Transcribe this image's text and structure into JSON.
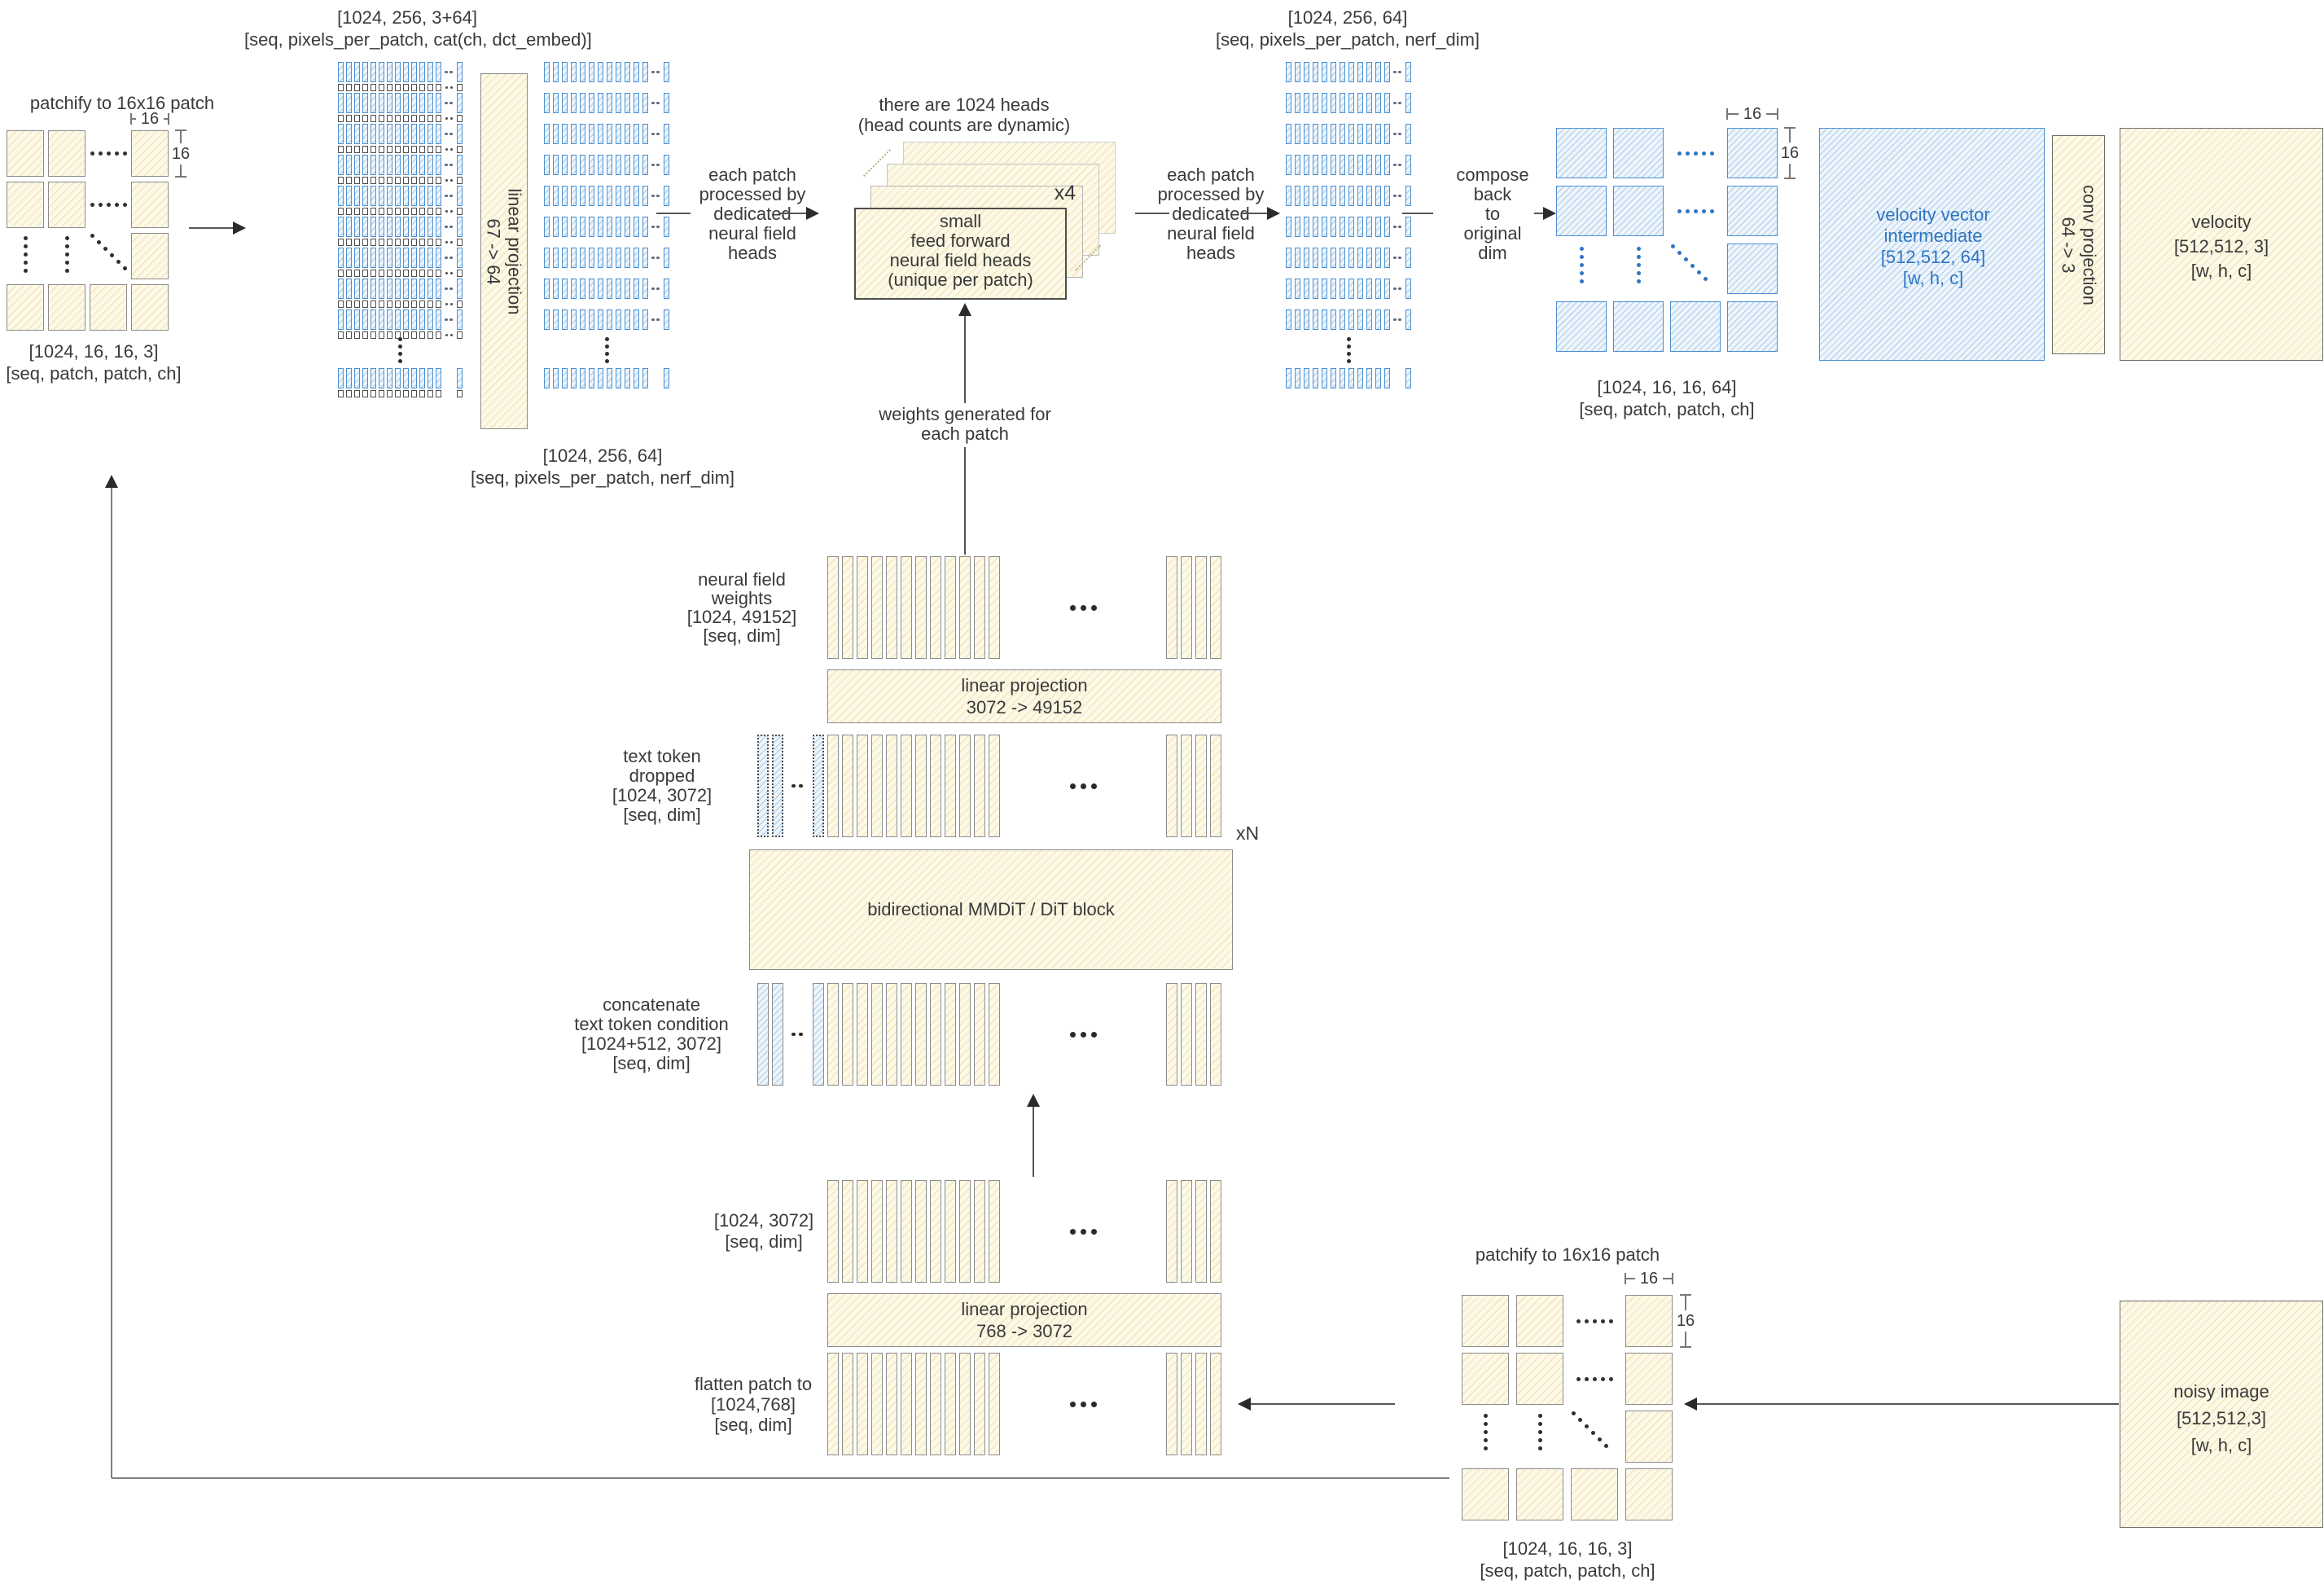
{
  "palette": {
    "cream_fill": "#fdf9e8",
    "cream_hatch": "#debE64",
    "blue_line": "#4a90d2",
    "blue_fill": "#eef5fb",
    "blue_text": "#2e75c3",
    "ink": "#3a3a3a",
    "arrow": "#2b2b2b"
  },
  "sixteen": "16",
  "top_left": {
    "title": "patchify to 16x16 patch",
    "shape": "[1024, 16, 16, 3]",
    "dims": "[seq, patch, patch, ch]"
  },
  "dct_label": {
    "shape": "[1024, 256, 3+64]",
    "dims": "[seq, pixels_per_patch, cat(ch, dct_embed)]"
  },
  "proj67": {
    "title": "linear projection",
    "map": "67 -> 64"
  },
  "nerf_label": {
    "shape": "[1024, 256, 64]",
    "dims": "[seq, pixels_per_patch, nerf_dim]"
  },
  "flow_left": [
    "each patch",
    "processed by",
    "dedicated",
    "neural field",
    "heads"
  ],
  "heads_note": [
    "there are 1024 heads",
    "(head counts are dynamic)"
  ],
  "ff_stack": {
    "lines": [
      "small",
      "feed forward",
      "neural field heads",
      "(unique per patch)"
    ],
    "multiplier": "x4"
  },
  "weights_gen": [
    "weights generated for",
    "each patch"
  ],
  "nerf_out_label": {
    "shape": "[1024, 256, 64]",
    "dims": "[seq, pixels_per_patch, nerf_dim]"
  },
  "flow_right": [
    "each patch",
    "processed by",
    "dedicated",
    "neural field",
    "heads"
  ],
  "compose": [
    "compose",
    "back",
    "to",
    "original",
    "dim"
  ],
  "patch_out": {
    "shape": "[1024, 16, 16, 64]",
    "dims": "[seq, patch, patch, ch]"
  },
  "velocity_intermediate": [
    "velocity vector",
    "intermediate",
    "[512,512, 64]",
    "[w, h, c]"
  ],
  "conv_proj": {
    "title": "conv projection",
    "map": "64 -> 3"
  },
  "velocity": [
    "velocity",
    "[512,512, 3]",
    "[w, h, c]"
  ],
  "nf_weights": [
    "neural field",
    "weights",
    "[1024, 49152]",
    "[seq, dim]"
  ],
  "proj3072": {
    "title": "linear projection",
    "map": "3072 -> 49152"
  },
  "text_dropped": [
    "text token",
    "dropped",
    "[1024, 3072]",
    "[seq, dim]"
  ],
  "xn": "xN",
  "mmdit": {
    "label": "bidirectional MMDiT / DiT block"
  },
  "concat": [
    "concatenate",
    "text token condition",
    "[1024+512, 3072]",
    "[seq, dim]"
  ],
  "seq3072": [
    "[1024, 3072]",
    "[seq, dim]"
  ],
  "proj768": {
    "title": "linear projection",
    "map": "768 -> 3072"
  },
  "flatten": [
    "flatten patch to",
    "[1024,768]",
    "[seq, dim]"
  ],
  "bottom_right": {
    "title": "patchify to 16x16 patch",
    "shape": "[1024, 16, 16, 3]",
    "dims": "[seq, patch, patch, ch]"
  },
  "noisy": [
    "noisy image",
    "[512,512,3]",
    "[w, h, c]"
  ]
}
